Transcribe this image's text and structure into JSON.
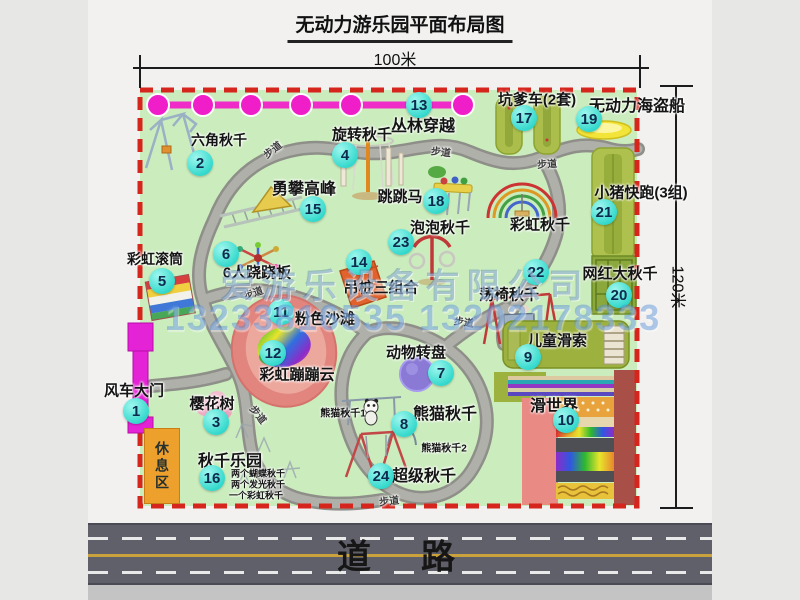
{
  "title": "无动力游乐园平面布局图",
  "dimensions": {
    "top": "100米",
    "right": "120米"
  },
  "road_label": "道　路",
  "zones": {
    "rest_area": "休息区"
  },
  "watermark": {
    "company": "爱游乐设备有限公司",
    "phone": "13233816535 13202178333"
  },
  "markers": [
    {
      "num": "1",
      "label": "风车大门",
      "cx": 136,
      "cy": 411,
      "lx": 134,
      "ly": 390,
      "fs": 15
    },
    {
      "num": "2",
      "label": "六角秋千",
      "cx": 200,
      "cy": 163,
      "lx": 219,
      "ly": 140,
      "fs": 14
    },
    {
      "num": "3",
      "label": "樱花树",
      "cx": 216,
      "cy": 422,
      "lx": 212,
      "ly": 403,
      "fs": 15
    },
    {
      "num": "4",
      "label": "旋转秋千",
      "cx": 345,
      "cy": 155,
      "lx": 362,
      "ly": 134,
      "fs": 15
    },
    {
      "num": "5",
      "label": "彩虹滚筒",
      "cx": 162,
      "cy": 281,
      "lx": 155,
      "ly": 259,
      "fs": 14
    },
    {
      "num": "6",
      "label": "6人跷跷板",
      "cx": 226,
      "cy": 254,
      "lx": 257,
      "ly": 272,
      "fs": 15
    },
    {
      "num": "7",
      "label": "动物转盘",
      "cx": 441,
      "cy": 373,
      "lx": 416,
      "ly": 352,
      "fs": 15
    },
    {
      "num": "8",
      "label": "熊猫秋千",
      "cx": 404,
      "cy": 424,
      "lx": 445,
      "ly": 412,
      "fs": 16
    },
    {
      "num": "9",
      "label": "儿童滑索",
      "cx": 528,
      "cy": 357,
      "lx": 557,
      "ly": 340,
      "fs": 15
    },
    {
      "num": "10",
      "label": "滑世界",
      "cx": 566,
      "cy": 420,
      "lx": 554,
      "ly": 404,
      "fs": 16
    },
    {
      "num": "11",
      "label": "粉色沙滩",
      "cx": 281,
      "cy": 312,
      "lx": 325,
      "ly": 318,
      "fs": 15
    },
    {
      "num": "12",
      "label": "彩虹蹦蹦云",
      "cx": 273,
      "cy": 353,
      "lx": 297,
      "ly": 374,
      "fs": 15
    },
    {
      "num": "13",
      "label": "丛林穿越",
      "cx": 419,
      "cy": 105,
      "lx": 423,
      "ly": 124,
      "fs": 16
    },
    {
      "num": "14",
      "label": "吊桩三组合",
      "cx": 359,
      "cy": 262,
      "lx": 381,
      "ly": 287,
      "fs": 15
    },
    {
      "num": "15",
      "label": "勇攀高峰",
      "cx": 313,
      "cy": 209,
      "lx": 304,
      "ly": 187,
      "fs": 16
    },
    {
      "num": "16",
      "label": "秋千乐园",
      "cx": 212,
      "cy": 478,
      "lx": 230,
      "ly": 459,
      "fs": 16
    },
    {
      "num": "17",
      "label": "坑爹车(2套)",
      "cx": 524,
      "cy": 118,
      "lx": 537,
      "ly": 99,
      "fs": 15
    },
    {
      "num": "18",
      "label": "跳跳马",
      "cx": 436,
      "cy": 201,
      "lx": 400,
      "ly": 196,
      "fs": 15
    },
    {
      "num": "19",
      "label": "无动力海盗船",
      "cx": 589,
      "cy": 119,
      "lx": 637,
      "ly": 104,
      "fs": 16
    },
    {
      "num": "20",
      "label": "网红大秋千",
      "cx": 619,
      "cy": 295,
      "lx": 620,
      "ly": 273,
      "fs": 15
    },
    {
      "num": "21",
      "label": "小猪快跑(3组)",
      "cx": 604,
      "cy": 212,
      "lx": 641,
      "ly": 192,
      "fs": 15
    },
    {
      "num": "22",
      "label": "荡椅秋千",
      "cx": 536,
      "cy": 272,
      "lx": 509,
      "ly": 294,
      "fs": 15
    },
    {
      "num": "23",
      "label": "泡泡秋千",
      "cx": 401,
      "cy": 242,
      "lx": 440,
      "ly": 227,
      "fs": 15
    },
    {
      "num": "24",
      "label": "超级秋千",
      "cx": 381,
      "cy": 476,
      "lx": 424,
      "ly": 474,
      "fs": 16
    }
  ],
  "sub_labels": [
    {
      "text": "彩虹秋千",
      "x": 540,
      "y": 224,
      "fs": 15
    },
    {
      "text": "熊猫秋千1",
      "x": 343,
      "y": 412,
      "fs": 10
    },
    {
      "text": "熊猫秋千2",
      "x": 444,
      "y": 447,
      "fs": 10
    },
    {
      "text": "两个蝴蝶秋千",
      "x": 258,
      "y": 473,
      "fs": 9
    },
    {
      "text": "两个发光秋千",
      "x": 258,
      "y": 484,
      "fs": 9
    },
    {
      "text": "一个彩虹秋千",
      "x": 256,
      "y": 495,
      "fs": 9
    }
  ],
  "path_labels": [
    {
      "text": "步道",
      "x": 272,
      "y": 149,
      "r": -38
    },
    {
      "text": "步道",
      "x": 441,
      "y": 151,
      "r": 6
    },
    {
      "text": "步道",
      "x": 547,
      "y": 163,
      "r": -4
    },
    {
      "text": "步道",
      "x": 253,
      "y": 292,
      "r": -18
    },
    {
      "text": "步道",
      "x": 259,
      "y": 414,
      "r": 52
    },
    {
      "text": "步道",
      "x": 464,
      "y": 321,
      "r": 8
    },
    {
      "text": "步道",
      "x": 389,
      "y": 500,
      "r": -6
    }
  ]
}
